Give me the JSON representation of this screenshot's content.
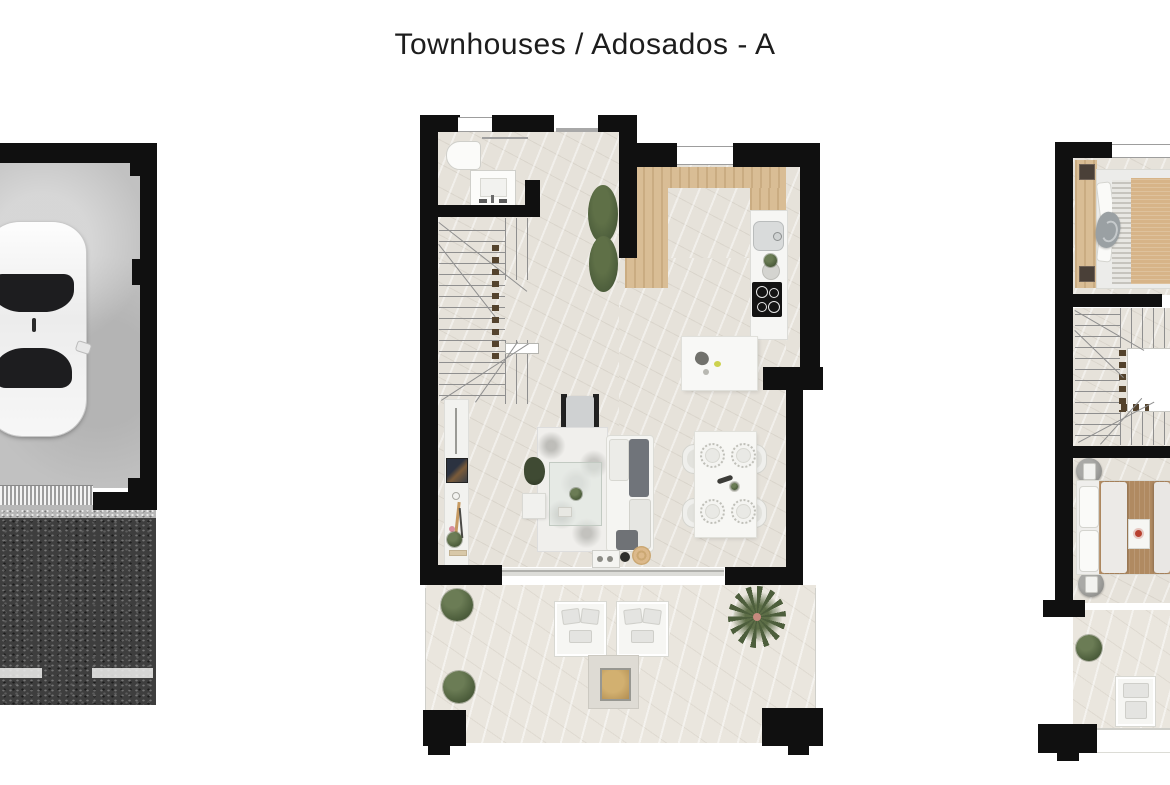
{
  "title": "Townhouses / Adosados  - A",
  "colors": {
    "wall": "#101010",
    "floor": "#e6e2da",
    "terrace_floor": "#eae6de",
    "concrete": "#c1c1c1",
    "asphalt": "#3e3e3e",
    "road_mark": "#f0f0ee",
    "wood": "#d9bd95",
    "counter_white": "#f6f6f4",
    "plant_green": "#4d5e3c",
    "plant_green_light": "#6b7c55",
    "furniture_white": "#f3f3f0",
    "sofa_gray": "#70747a",
    "tan": "#d7b488",
    "bed_brown": "#b08a61",
    "line_gray": "#8f8f8f",
    "title_text": "#1d1d1d"
  },
  "plans": {
    "garage": {
      "id": "garage-plan",
      "items": [
        "car",
        "garage-door",
        "driveway-asphalt",
        "lane-marking"
      ]
    },
    "ground_floor": {
      "id": "ground-floor-plan",
      "rooms": [
        "bathroom",
        "staircase",
        "kitchen",
        "living-room",
        "dining-area",
        "terrace"
      ],
      "items": [
        "toilet",
        "vanity-sink",
        "hedge-plant",
        "wood-counter",
        "kitchen-sink",
        "cooktop",
        "kitchen-island",
        "sideboard",
        "armchair",
        "rug",
        "coffee-table",
        "sofa",
        "ottoman",
        "dining-table",
        "dining-chairs",
        "plates",
        "sun-loungers",
        "fire-pit",
        "bushes",
        "palm-plant",
        "sliding-glass-door"
      ]
    },
    "upper_floor": {
      "id": "upper-floor-plan",
      "rooms": [
        "bedroom-1",
        "staircase-void",
        "bedroom-2",
        "balcony-terrace"
      ],
      "items": [
        "double-bed-1",
        "wood-headboard",
        "double-bed-2",
        "nightstands",
        "lounger",
        "bush"
      ]
    }
  }
}
